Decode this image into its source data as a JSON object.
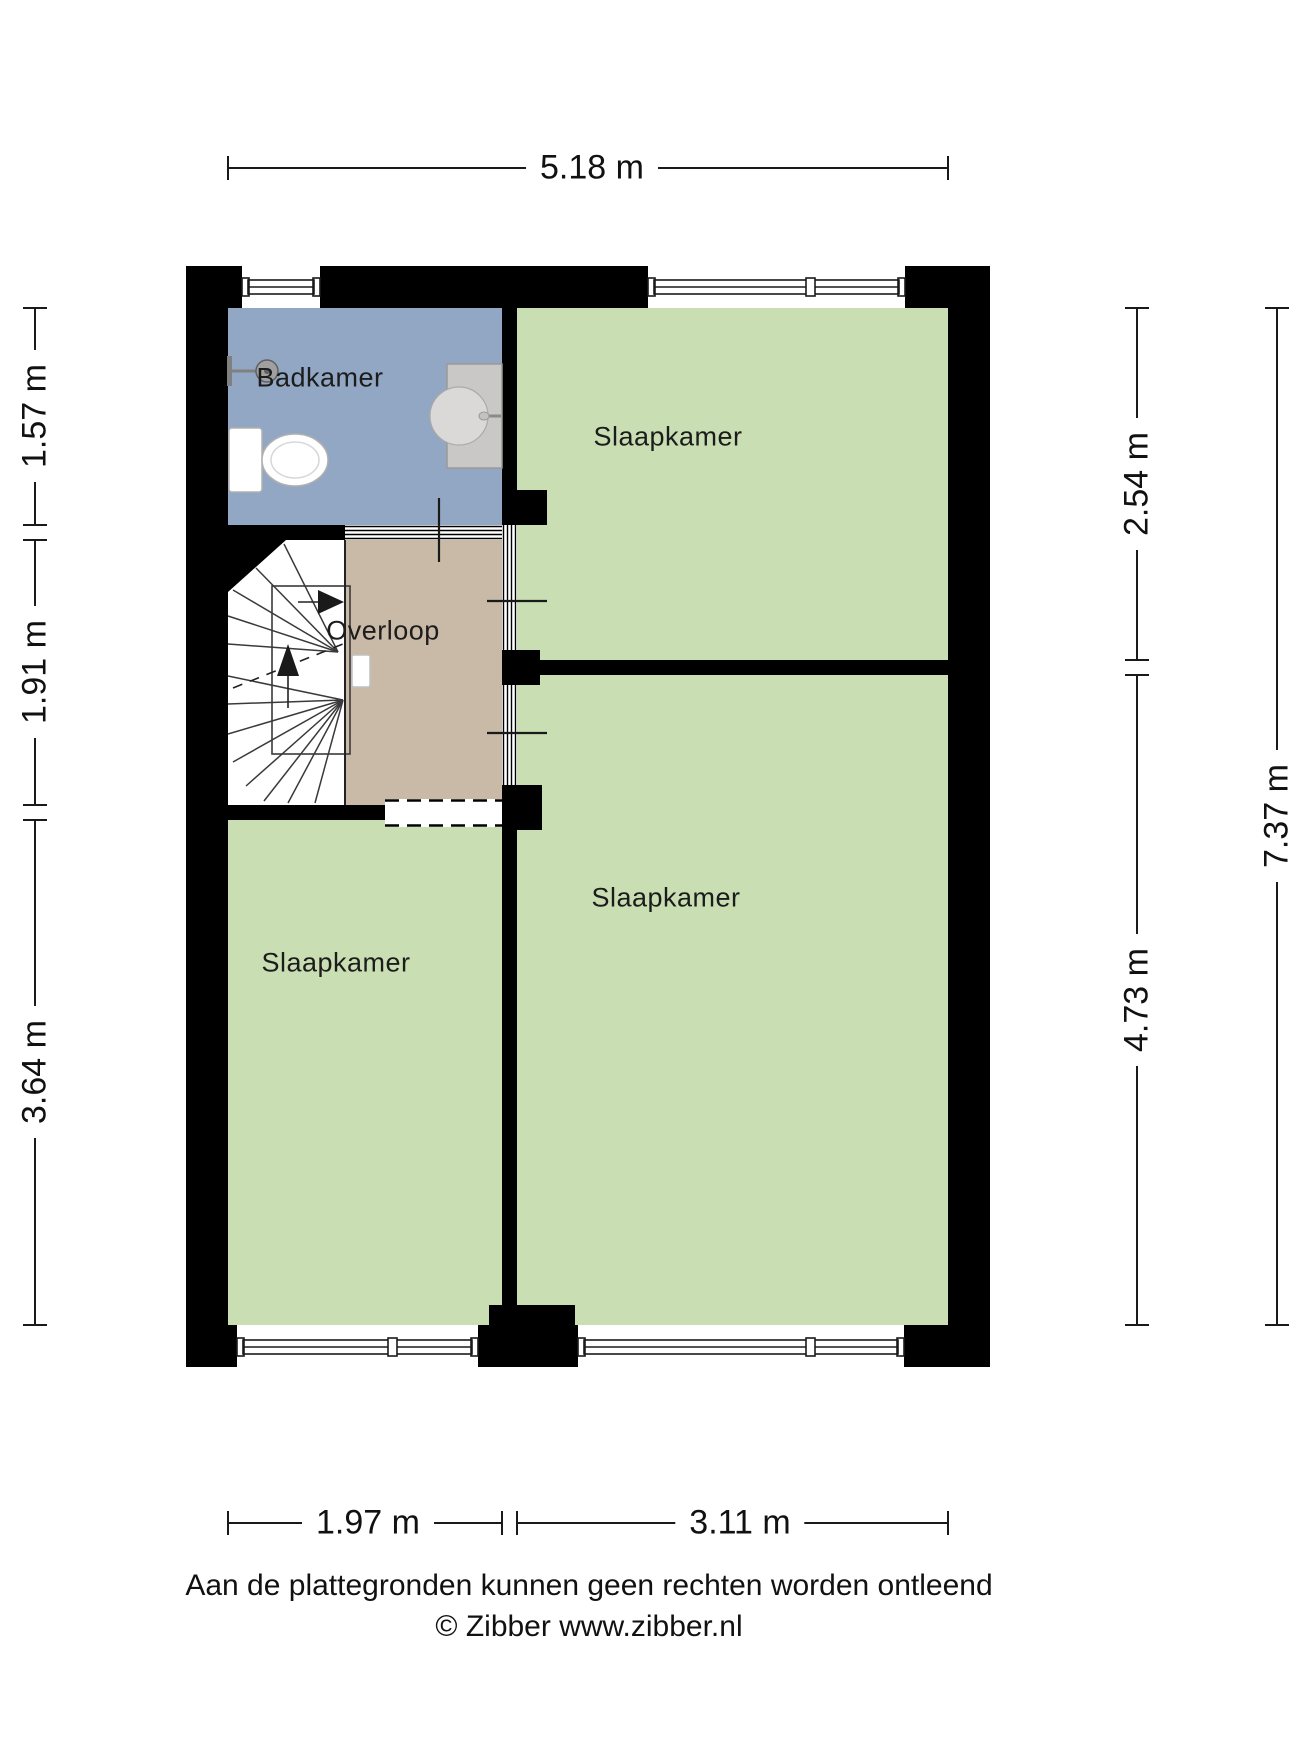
{
  "floorplan": {
    "rooms": [
      {
        "name": "Badkamer"
      },
      {
        "name": "Slaapkamer"
      },
      {
        "name": "Overloop"
      },
      {
        "name": "Slaapkamer"
      },
      {
        "name": "Slaapkamer"
      }
    ],
    "colors": {
      "wall": "#000000",
      "bathroom": "#92a7c3",
      "bedroom": "#c9deb2",
      "landing": "#c9b9a7",
      "stairs": "#ffffff"
    }
  },
  "dimensions": {
    "top": "5.18 m",
    "left_top": "1.57 m",
    "left_middle": "1.91 m",
    "left_bottom": "3.64 m",
    "right_top": "2.54 m",
    "right_bottom": "4.73 m",
    "right_total": "7.37 m",
    "bottom_left": "1.97 m",
    "bottom_right": "3.11 m"
  },
  "footer": {
    "disclaimer": "Aan de plattegronden kunnen geen rechten worden ontleend",
    "copyright": "© Zibber www.zibber.nl"
  }
}
